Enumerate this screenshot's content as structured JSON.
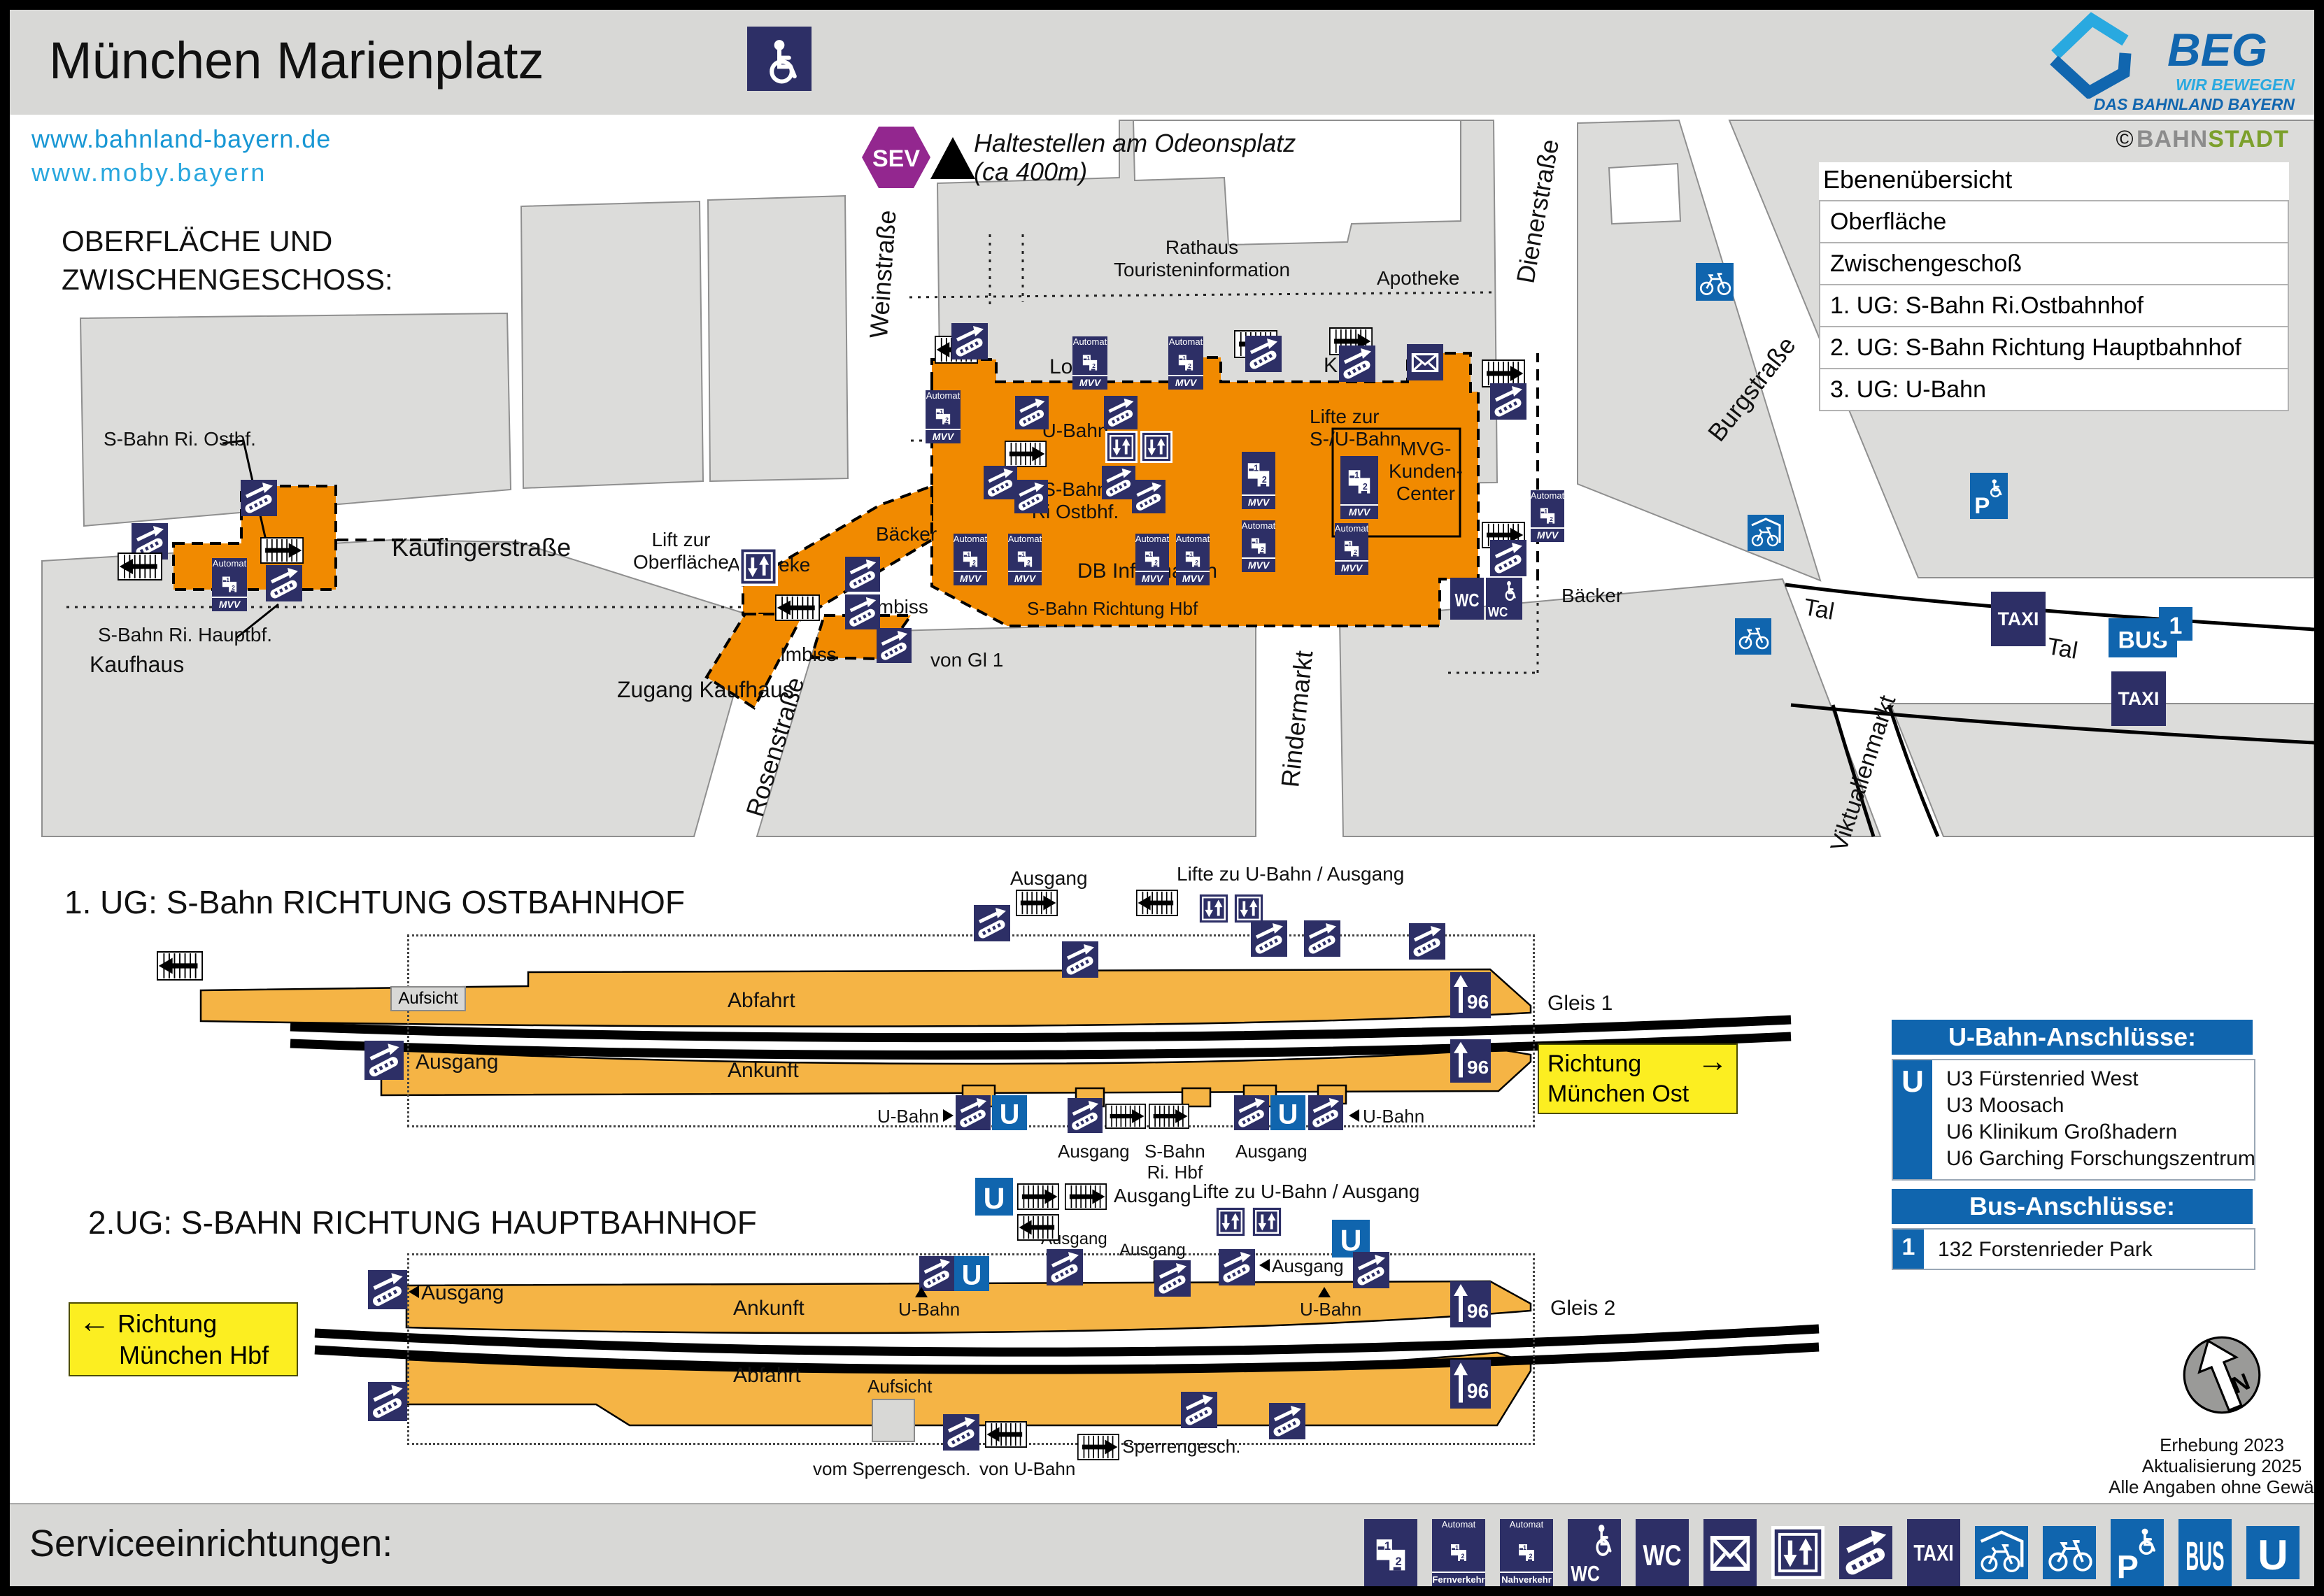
{
  "colors": {
    "navy": "#2d2f66",
    "blue": "#1065ae",
    "orange": "#f18a00",
    "amber": "#f5b445",
    "yellow": "#fcee21",
    "purple": "#93278f",
    "gray_block": "#dcdcda"
  },
  "header": {
    "title": "München Marienplatz",
    "link1": "www.bahnland-bayern.de",
    "link2": "www.moby.bayern",
    "beg_name": "BEG",
    "beg_tag1": "WIR BEWEGEN",
    "beg_tag2": "DAS BAHNLAND BAYERN",
    "credit_c": "©",
    "credit_a": "BAHN",
    "credit_b": "STADT"
  },
  "levels": {
    "title": "Ebenenübersicht",
    "rows": [
      "Oberfläche",
      "Zwischengeschoß",
      "1. UG: S-Bahn Ri.Ostbahnhof",
      "2. UG: S-Bahn Richtung Hauptbahnhof",
      "3. UG: U-Bahn"
    ]
  },
  "surface": {
    "h1": "OBERFLÄCHE UND",
    "h2": "ZWISCHENGESCHOSS:",
    "odeon1": "Haltestellen am Odeonsplatz",
    "odeon2": "(ca 400m)"
  },
  "streets": {
    "weinstrasse": "Weinstraße",
    "dienerstrasse": "Dienerstraße",
    "burgstrasse": "Burgstraße",
    "kaufingerstrasse": "Kaufingerstraße",
    "rosenstrasse": "Rosenstraße",
    "rindermarkt": "Rindermarkt",
    "tal": "Tal",
    "viktualienmarkt": "Viktualienmarkt"
  },
  "map": {
    "rathaus1": "Rathaus",
    "rathaus2": "Touristeninformation",
    "apotheke": "Apotheke",
    "lotto": "Lotto",
    "kiosk": "Kiosk",
    "ubahn": "U-Bahn",
    "lifte1": "Lifte zur",
    "lifte2": "S-/U-Bahn",
    "sbahn1": "S-Bahn",
    "sbahn2": "Ri Ostbhf.",
    "mvg1": "MVG-",
    "mvg2": "Kunden-",
    "mvg3": "Center",
    "db": "DB Information",
    "sbahn_hbf": "S-Bahn Richtung Hbf",
    "baecker": "Bäcker",
    "imbiss": "Imbiss",
    "von_gl": "von Gl 1",
    "lift1": "Lift zur",
    "lift2": "Oberfläche",
    "kaufhaus": "Kaufhaus",
    "zugang": "Zugang Kaufhaus",
    "callout_ostbf": "S-Bahn Ri. Ostbf.",
    "callout_hauptbf": "S-Bahn Ri. Hauptbf."
  },
  "l1": {
    "heading": "1. UG: S-Bahn RICHTUNG OSTBAHNHOF",
    "ausgang": "Ausgang",
    "lifte_zu": "Lifte zu U-Bahn / Ausgang",
    "aufsicht": "Aufsicht",
    "abfahrt": "Abfahrt",
    "ankunft": "Ankunft",
    "gleis": "Gleis 1",
    "ubahn": "U-Bahn",
    "sb1": "S-Bahn",
    "sb2": "Ri. Hbf",
    "dir1": "Richtung",
    "dir2": "München Ost",
    "arrow": "→"
  },
  "l2": {
    "heading": "2.UG: S-BAHN RICHTUNG HAUPTBAHNHOF",
    "dir1": "Richtung",
    "dir2": "München Hbf",
    "arrow": "←",
    "ausgang": "Ausgang",
    "lifte_zu": "Lifte zu U-Bahn / Ausgang",
    "ankunft": "Ankunft",
    "abfahrt": "Abfahrt",
    "aufsicht": "Aufsicht",
    "gleis": "Gleis 2",
    "ubahn": "U-Bahn",
    "vom_sperr": "vom Sperrengesch.",
    "von_ubahn": "von U-Bahn"
  },
  "conn": {
    "ub_title": "U-Bahn-Anschlüsse:",
    "ub_badge": "U",
    "ub1": "U3 Fürstenried West",
    "ub2": "U3 Moosach",
    "ub3": "U6 Klinikum Großhadern",
    "ub4": "U6 Garching Forschungszentrum",
    "bus_title": "Bus-Anschlüsse:",
    "bus_badge": "1",
    "bus1": "132 Forstenrieder Park"
  },
  "footer": {
    "title": "Serviceeinrichtungen:",
    "note1": "Erhebung 2023",
    "note2": "Aktualisierung 2025",
    "note3": "Alle Angaben ohne Gewähr!"
  },
  "ic": {
    "sev": "SEV",
    "automat": "Automat",
    "mvv": "MVV",
    "fern": "Fernverkehr",
    "nah": "Nahverkehr",
    "wc": "WC",
    "taxi": "TAXI",
    "bus": "BUS",
    "u": "U",
    "p": "P",
    "n": "N",
    "g96": "96",
    "t1": "1",
    "t2": "2",
    "bus1": "1"
  }
}
